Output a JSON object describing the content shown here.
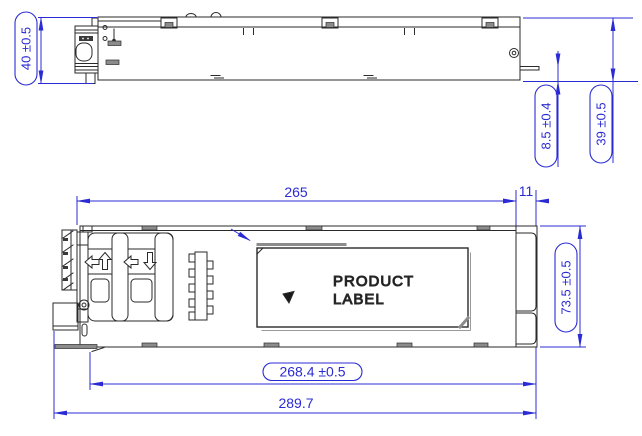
{
  "drawing": {
    "kind": "engineering-drawing",
    "colors": {
      "dimension": "#2b2bd4",
      "line": "#2a2a2a",
      "hardware_gray": "#8c8c8c",
      "background": "#ffffff"
    }
  },
  "side_view": {
    "dim_height_overall": "40 ±0.5",
    "dim_connector_offset": "8.5 ±0.4",
    "dim_height_body": "39 ±0.5"
  },
  "plan_view": {
    "dim_body_length": "265",
    "dim_connector_length": "11",
    "dim_width": "73.5 ±0.5",
    "dim_length_to_latch": "268.4 ±0.5",
    "dim_length_overall": "289.7",
    "product_label": {
      "line1": "PRODUCT",
      "line2": "LABEL"
    }
  }
}
